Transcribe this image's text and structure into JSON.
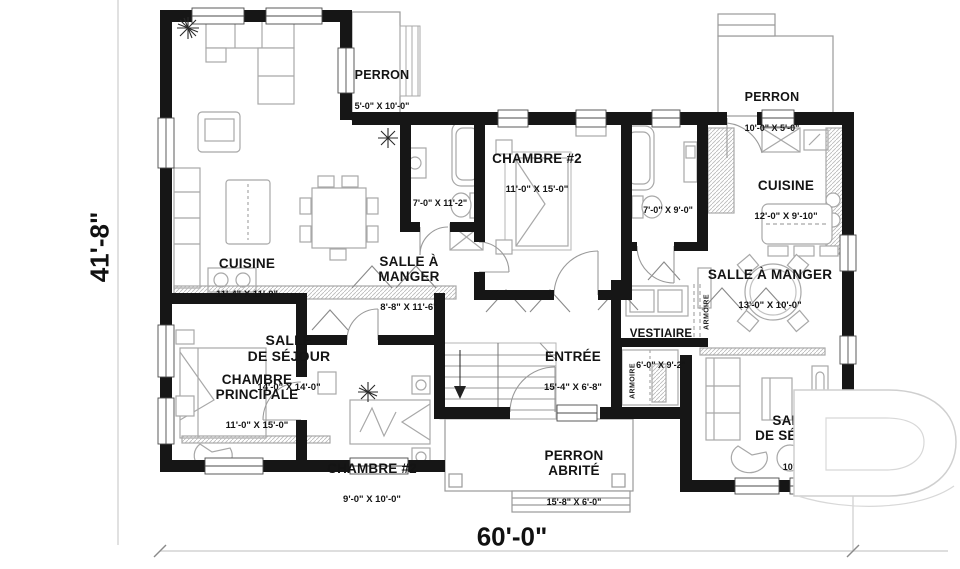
{
  "dimensions": {
    "overall_width": "60'-0\"",
    "overall_height": "41'-8\""
  },
  "rooms": [
    {
      "id": "salle-de-sejour-left",
      "name": "SALLE\nDE SÉJOUR",
      "dims": "14'-0\" X 14'-0\""
    },
    {
      "id": "perron-top-left",
      "name": "PERRON",
      "dims": "5'-0\" X 10'-0\""
    },
    {
      "id": "chambre-2-top",
      "name": "CHAMBRE #2",
      "dims": "11'-0\" X 15'-0\""
    },
    {
      "id": "salle-de-bain-1",
      "name": "",
      "dims": "7'-0\" X 11'-2\""
    },
    {
      "id": "perron-top-right",
      "name": "PERRON",
      "dims": "10'-0\" X 5'-0\""
    },
    {
      "id": "cuisine-right",
      "name": "CUISINE",
      "dims": "12'-0\" X 9'-10\""
    },
    {
      "id": "salle-de-bain-2",
      "name": "",
      "dims": "7'-0\" X 9'-0\""
    },
    {
      "id": "cuisine-left",
      "name": "CUISINE",
      "dims": "11'-4\" X 11'-0\""
    },
    {
      "id": "salle-a-manger-left",
      "name": "SALLE À\nMANGER",
      "dims": "8'-8\" X 11'-6\""
    },
    {
      "id": "salle-a-manger-right",
      "name": "SALLE À MANGER",
      "dims": "13'-0\" X 10'-0\""
    },
    {
      "id": "vestiaire",
      "name": "VESTIAIRE",
      "dims": "6'-0\" X 9'-2\""
    },
    {
      "id": "entree",
      "name": "ENTRÉE",
      "dims": "15'-4\" X 6'-8\""
    },
    {
      "id": "chambre-principale",
      "name": "CHAMBRE\nPRINCIPALE",
      "dims": "11'-0\" X 15'-0\""
    },
    {
      "id": "chambre-2-bottom",
      "name": "CHAMBRE #2",
      "dims": "9'-0\" X 10'-0\""
    },
    {
      "id": "perron-abrite",
      "name": "PERRON\nABRITÉ",
      "dims": "15'-8\" X 6'-0\""
    },
    {
      "id": "salle-de-sejour-right",
      "name": "SALLE\nDE SÉJOUR",
      "dims": "10'-6\""
    }
  ],
  "closet_labels": {
    "vestiaire_armoire": "ARMOIRE",
    "entree_armoire": "ARMOIRE"
  },
  "colors": {
    "wall": "#161616",
    "furniture": "#a8a8a8",
    "text": "#141414",
    "watermark_stroke": "#cfcfcf"
  }
}
